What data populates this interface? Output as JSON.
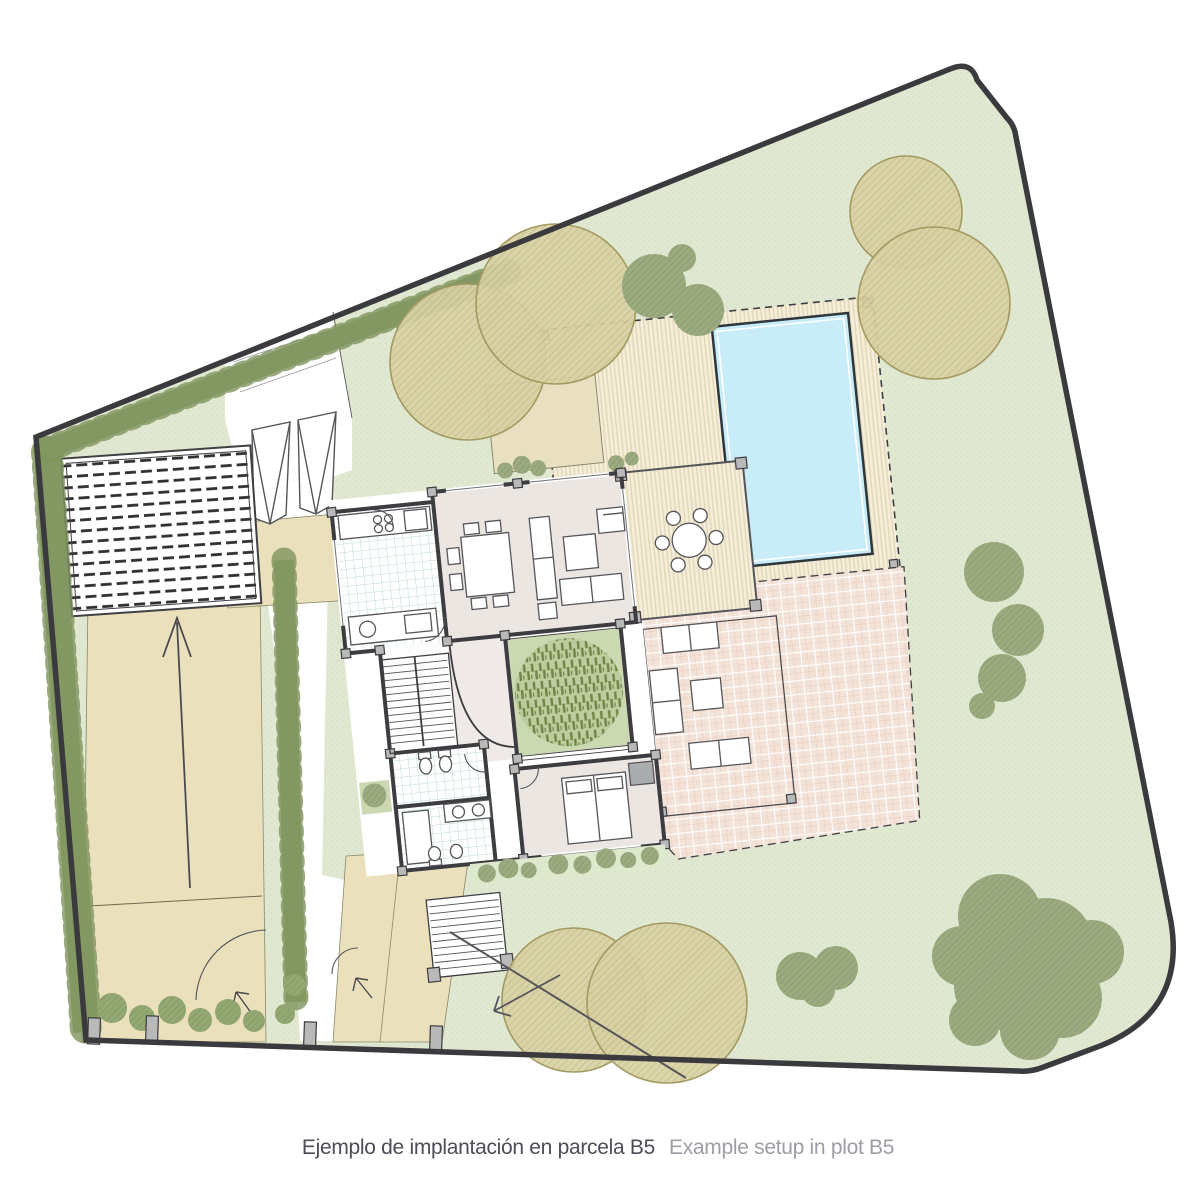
{
  "caption": {
    "title_es": "Ejemplo de implantación en parcela B5",
    "title_en": "Example setup in plot B5"
  },
  "palette": {
    "paper": "#ffffff",
    "line": "#3a3a3f",
    "lawn": "#e1e8d2",
    "lawn-dot": "#cdd8b8",
    "hedge": "#93a873",
    "hedge-dark": "#7f935e",
    "tree-tan": "#d8d1a3",
    "tree-tan-edge": "#a39a62",
    "tree-green": "#9cab7f",
    "tree-green-dark": "#849566",
    "drive": "#eae0bc",
    "patio": "#e9e0c2",
    "deck": "#f4eeda",
    "deck-stripe": "#e2d6b5",
    "pool": "#c8ecf8",
    "terrace": "#f3e2d7",
    "floor": "#ebe6e2",
    "court": "#ccd8b2",
    "court-tree": "#6e8548",
    "tile-line": "#bedad4",
    "wall": "#3c3c41",
    "caption": "#4d4d57",
    "caption2": "#9d9da5"
  },
  "plan_zones": {
    "site": "plot-B5-site-plan",
    "zones": [
      "lawn",
      "perimeter-hedge",
      "carport-pergola",
      "driveway",
      "entrance-gates",
      "walkway",
      "swimming-pool",
      "pool-deck",
      "covered-pergola-dining",
      "house",
      "kitchen",
      "dining-room",
      "living-room",
      "inner-courtyard",
      "bedroom",
      "bathrooms",
      "stairs",
      "terrace",
      "planting-bed",
      "trees"
    ]
  }
}
